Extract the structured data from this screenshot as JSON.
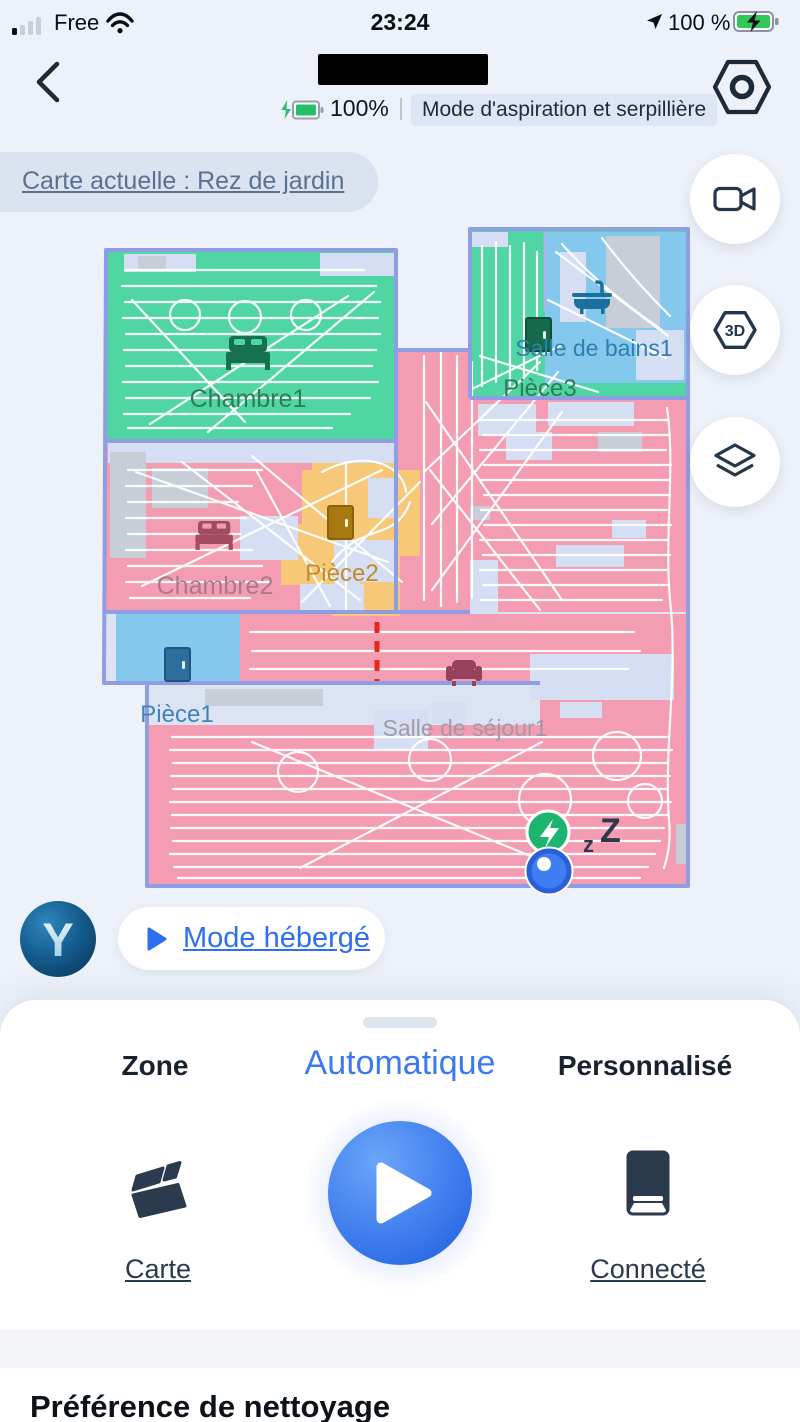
{
  "colors": {
    "accent_blue": "#3b79f2",
    "room_green": "#4fd6a2",
    "room_pink": "#f49cb2",
    "room_blue": "#85c8ed",
    "room_yellow": "#f6c878",
    "dock_green": "#1cb46e",
    "wall_purple": "#8f9de3",
    "virtual_wall_red": "#e5261d"
  },
  "status_bar": {
    "carrier": "Free",
    "time": "23:24",
    "battery": "100 %"
  },
  "header": {
    "battery_level": "100%",
    "divider": "|",
    "mode_label": "Mode d'aspiration et serpillière"
  },
  "map_banner": {
    "label": "Carte actuelle : Rez de jardin"
  },
  "floating_buttons": {
    "three_d_label": "3D"
  },
  "map": {
    "rooms": {
      "chambre1": {
        "label": "Chambre1"
      },
      "salle_de_bains1": {
        "label": "Salle de bains1"
      },
      "piece3": {
        "label": "Pièce3"
      },
      "chambre2": {
        "label": "Chambre2"
      },
      "piece2": {
        "label": "Pièce2"
      },
      "piece1": {
        "label": "Pièce1"
      },
      "salle_de_sejour1": {
        "label": "Salle de séjour1"
      }
    },
    "sleep_indicator": {
      "small": "z",
      "big": "Z"
    }
  },
  "hosted_mode": {
    "label": "Mode hébergé",
    "logo_letter": "Y"
  },
  "sheet": {
    "tabs": [
      {
        "label": "Zone",
        "active": false
      },
      {
        "label": "Automatique",
        "active": true
      },
      {
        "label": "Personnalisé",
        "active": false
      }
    ],
    "map_action": "Carte",
    "dock_status": "Connecté"
  },
  "section": {
    "title": "Préférence de nettoyage"
  }
}
